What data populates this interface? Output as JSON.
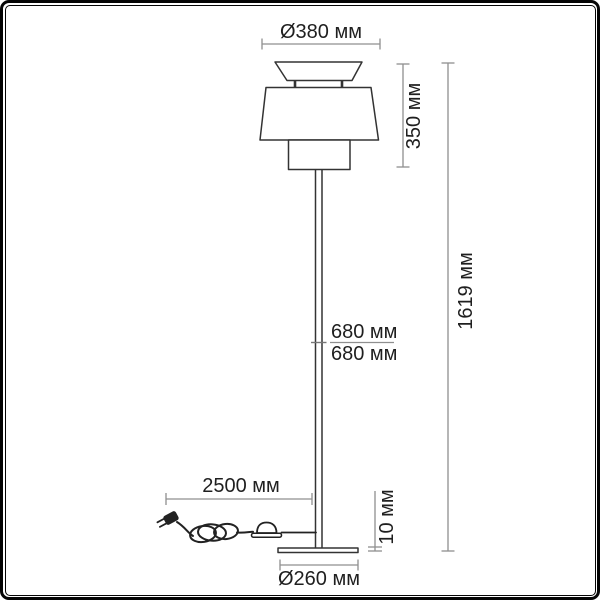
{
  "figure": {
    "type": "technical dimension drawing",
    "subject": "floor lamp with tiered shade, pole, round base, foot switch and power cord",
    "colors": {
      "background": "#ffffff",
      "frame": "#050505",
      "outline": "#333333",
      "dimension_line": "#8f8f8f",
      "text": "#1f1f1f"
    },
    "labels": {
      "top_diameter": "Ø380 мм",
      "shade_height": "350 мм",
      "total_height": "1619 мм",
      "pole_upper": "680 мм",
      "pole_lower": "680 мм",
      "cord_length": "2500 мм",
      "base_thickness": "10 мм",
      "base_diameter": "Ø260 мм"
    }
  }
}
